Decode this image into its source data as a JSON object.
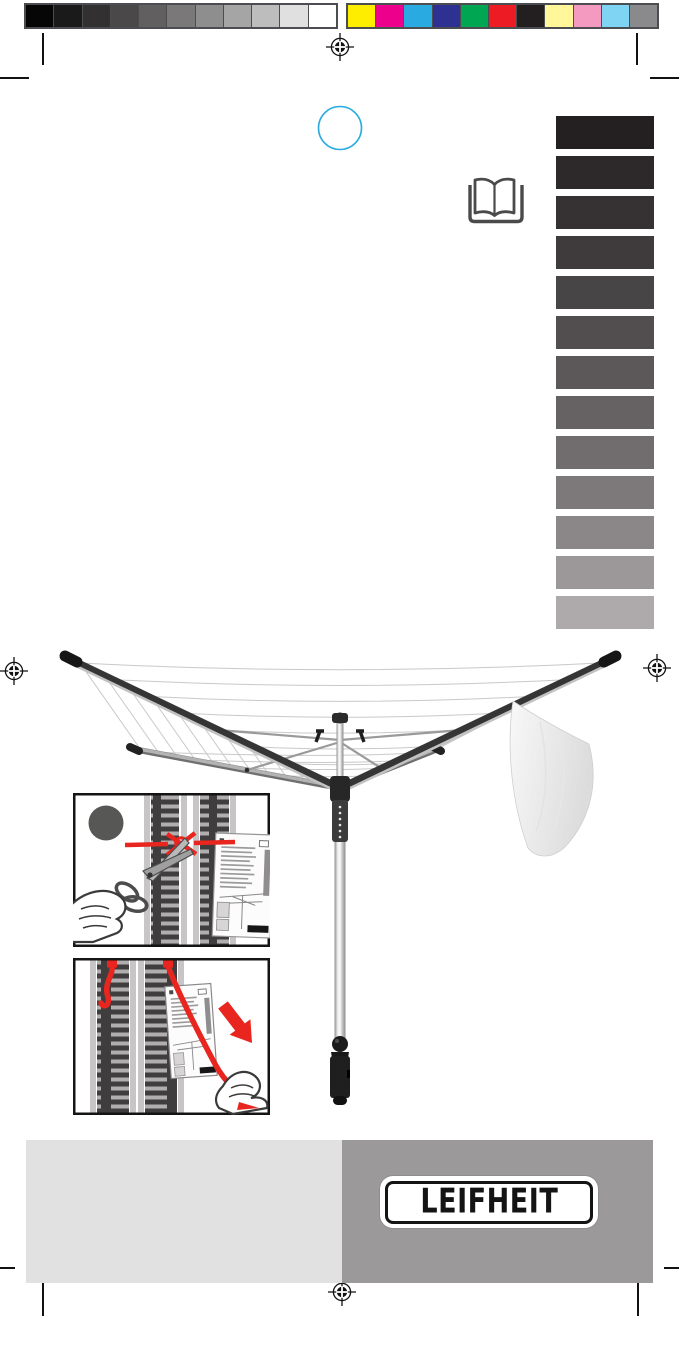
{
  "print_bars": {
    "grayscale": [
      "#060606",
      "#1b1a1a",
      "#323031",
      "#4a4849",
      "#615f60",
      "#7a7879",
      "#8f8e8f",
      "#a6a5a6",
      "#bebdbe",
      "#e1e0e0",
      "#ffffff"
    ],
    "colors": [
      "#ffed00",
      "#ec008c",
      "#29abe2",
      "#2e3192",
      "#00a651",
      "#ed1c24",
      "#231f20",
      "#fff799",
      "#f49ac1",
      "#7fd4f4",
      "#8a8a8d"
    ]
  },
  "language_tabs": [
    "#242021",
    "#2d292a",
    "#363233",
    "#3f3b3c",
    "#484546",
    "#524e4f",
    "#5c5859",
    "#666263",
    "#716d6e",
    "#7d797a",
    "#8b8788",
    "#9c9899",
    "#aeaaab"
  ],
  "icons": {
    "registration_mark": "crosshair-target",
    "book": "open-book",
    "step_circle": "filled-gray-circle",
    "cyan_circle": "thin-circle-outline",
    "scissors": "scissors-cutting-cord",
    "red_arrow": "thick-arrow-down-right",
    "hand": "hand-outline"
  },
  "illustration": {
    "subject": "rotary-clothes-dryer-with-hanging-cloth",
    "frame_color": "#353535",
    "aluminum_color": "#b9b9b9",
    "line_color": "#c9c9c9",
    "cloth_color": "#efefef"
  },
  "footer": {
    "logo_text": "LEIFHEIT",
    "left_panel_color": "#e2e1e1",
    "right_panel_color": "#9b999a",
    "logo_text_color": "#141414"
  },
  "accents": {
    "red": "#e8251f",
    "cyan": "#29abe2"
  }
}
